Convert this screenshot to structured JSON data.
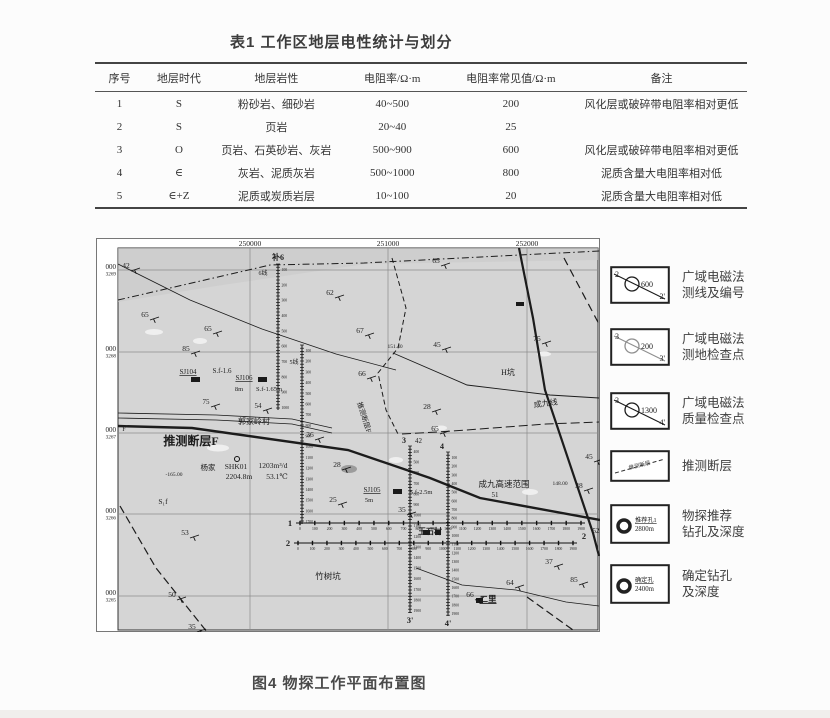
{
  "table": {
    "title": "表1 工作区地层电性统计与划分",
    "headers": [
      "序号",
      "地层时代",
      "地层岩性",
      "电阻率/Ω·m",
      "电阻率常见值/Ω·m",
      "备注"
    ],
    "col_widths": [
      48,
      70,
      122,
      108,
      136,
      168
    ],
    "rows": [
      [
        "1",
        "S",
        "粉砂岩、细砂岩",
        "40~500",
        "200",
        "风化层或破碎带电阻率相对更低"
      ],
      [
        "2",
        "S",
        "页岩",
        "20~40",
        "25",
        ""
      ],
      [
        "3",
        "O",
        "页岩、石英砂岩、灰岩",
        "500~900",
        "600",
        "风化层或破碎带电阻率相对更低"
      ],
      [
        "4",
        "∈",
        "灰岩、泥质灰岩",
        "500~1000",
        "800",
        "泥质含量大电阻率相对低"
      ],
      [
        "5",
        "∈+Z",
        "泥质或炭质岩层",
        "10~100",
        "20",
        "泥质含量大电阻率相对低"
      ]
    ]
  },
  "figure": {
    "caption": "图4 物探工作平面布置图",
    "map": {
      "bg": "#d5d5d5",
      "band": "#c9c9c9",
      "easting": [
        {
          "t": "250000",
          "x": 154
        },
        {
          "t": "251000",
          "x": 292
        },
        {
          "t": "252000",
          "x": 431
        }
      ],
      "northing": [
        {
          "a": "000",
          "b": "3269",
          "y": 32
        },
        {
          "a": "000",
          "b": "3268",
          "y": 114
        },
        {
          "a": "000",
          "b": "3267",
          "y": 195
        },
        {
          "a": "000",
          "b": "3266",
          "y": 276
        },
        {
          "a": "000",
          "b": "3265",
          "y": 358
        }
      ],
      "grid": {
        "vx": [
          154,
          292,
          431
        ],
        "hy": [
          32,
          114,
          195,
          276,
          358
        ]
      },
      "paths": [
        {
          "pts": [
            [
              22,
              62
            ],
            [
              174,
              27
            ],
            [
              268,
              25
            ],
            [
              423,
              17
            ],
            [
              504,
              13
            ]
          ],
          "w": 1,
          "dash": "7,3,1.5,3"
        },
        {
          "pts": [
            [
              22,
              26
            ],
            [
              94,
              62
            ],
            [
              166,
              91
            ],
            [
              240,
              116
            ],
            [
              300,
              132
            ]
          ],
          "w": 0.8
        },
        {
          "pts": [
            [
              297,
              115
            ],
            [
              371,
              147
            ],
            [
              454,
              157
            ],
            [
              503,
              160
            ]
          ],
          "w": 0.9
        },
        {
          "pts": [
            [
              423,
              10
            ],
            [
              437,
              80
            ],
            [
              449,
              152
            ],
            [
              497,
              295
            ],
            [
              503,
              318
            ]
          ],
          "w": 2.2
        },
        {
          "pts": [
            [
              468,
              20
            ],
            [
              504,
              88
            ]
          ],
          "w": 1.2,
          "dash": "8,5"
        },
        {
          "pts": [
            [
              22,
              188
            ],
            [
              96,
              190
            ],
            [
              252,
              212
            ],
            [
              334,
              240
            ],
            [
              384,
              260
            ],
            [
              504,
              282
            ]
          ],
          "w": 2.4
        },
        {
          "pts": [
            [
              22,
              175
            ],
            [
              120,
              177
            ],
            [
              196,
              181
            ],
            [
              236,
              190
            ]
          ],
          "w": 0.8
        },
        {
          "pts": [
            [
              22,
              180
            ],
            [
              120,
              182
            ],
            [
              196,
              186
            ],
            [
              236,
              195
            ]
          ],
          "w": 0.8
        },
        {
          "pts": [
            [
              296,
              20
            ],
            [
              310,
              70
            ],
            [
              302,
              110
            ],
            [
              282,
              135
            ],
            [
              290,
              172
            ],
            [
              302,
              196
            ]
          ],
          "w": 1,
          "dash": "5,3"
        },
        {
          "pts": [
            [
              306,
              196
            ],
            [
              357,
              193
            ],
            [
              450,
              186
            ],
            [
              503,
              184
            ]
          ],
          "w": 1,
          "dash": "9,4"
        },
        {
          "pts": [
            [
              24,
              268
            ],
            [
              60,
              330
            ],
            [
              111,
              394
            ]
          ],
          "w": 1.2,
          "dash": "8,4"
        },
        {
          "pts": [
            [
              431,
              359
            ],
            [
              477,
              392
            ]
          ],
          "w": 1.2,
          "dash": "8,4"
        },
        {
          "pts": [
            [
              320,
              330
            ],
            [
              366,
              347
            ],
            [
              420,
              352
            ],
            [
              470,
              364
            ],
            [
              503,
              368
            ]
          ],
          "w": 0.8
        }
      ],
      "v_lines": [
        {
          "x": 182,
          "y1": 26,
          "y2": 172,
          "stations": [
            "100",
            "200",
            "300",
            "400",
            "500",
            "600",
            "700",
            "800",
            "900",
            "1000"
          ]
        },
        {
          "x": 206,
          "y1": 107,
          "y2": 286,
          "stations": [
            "100",
            "200",
            "300",
            "400",
            "500",
            "600",
            "700",
            "800",
            "900",
            "1000",
            "1100",
            "1200",
            "1300",
            "1400",
            "1500",
            "1600",
            "1700"
          ]
        },
        {
          "x": 314,
          "y1": 208,
          "y2": 375,
          "top": "3",
          "top2": "42",
          "bottom": "3'",
          "stations": [
            "400",
            "500",
            "600",
            "700",
            "800",
            "900",
            "1000",
            "1100",
            "1200",
            "1300",
            "1400",
            "1500",
            "1600",
            "1700",
            "1800",
            "1900"
          ]
        },
        {
          "x": 352,
          "y1": 214,
          "y2": 378,
          "top": "4",
          "bottom": "4'",
          "stations": [
            "100",
            "200",
            "300",
            "400",
            "500",
            "600",
            "700",
            "800",
            "900",
            "1000",
            "1100",
            "1200",
            "1300",
            "1400",
            "1500",
            "1600",
            "1700",
            "1800",
            "1900"
          ]
        }
      ],
      "h_lines": [
        {
          "y": 285,
          "x1": 200,
          "x2": 489,
          "left": "1",
          "stations": [
            "0",
            "100",
            "200",
            "300",
            "400",
            "500",
            "600",
            "700",
            "800",
            "900",
            "1000",
            "1100",
            "1200",
            "1300",
            "1400",
            "1500",
            "1600",
            "1700",
            "1800",
            "1900"
          ]
        },
        {
          "y": 305,
          "x1": 198,
          "x2": 481,
          "left": "2",
          "right": "2",
          "stations": [
            "0",
            "100",
            "200",
            "300",
            "400",
            "500",
            "600",
            "700",
            "800",
            "900",
            "1000",
            "1100",
            "1200",
            "1300",
            "1400",
            "1500",
            "1600",
            "1700",
            "1800",
            "1900"
          ]
        }
      ],
      "labels": [
        {
          "t": "42",
          "x": 30,
          "y": 30,
          "s": 7.5,
          "dip": 1
        },
        {
          "t": "补6",
          "x": 182,
          "y": 22,
          "s": 8,
          "b": 1
        },
        {
          "t": "6线",
          "x": 167,
          "y": 37,
          "s": 6
        },
        {
          "t": "5线",
          "x": 198,
          "y": 126,
          "s": 6
        },
        {
          "t": "65",
          "x": 49,
          "y": 79,
          "s": 7.5,
          "dip": 1
        },
        {
          "t": "65",
          "x": 112,
          "y": 93,
          "s": 7.5,
          "dip": 1
        },
        {
          "t": "85",
          "x": 90,
          "y": 113,
          "s": 7.5,
          "dip": 1
        },
        {
          "t": "62",
          "x": 234,
          "y": 57,
          "s": 7.5,
          "dip": 1
        },
        {
          "t": "67",
          "x": 264,
          "y": 95,
          "s": 7.5,
          "dip": 1
        },
        {
          "t": "65",
          "x": 340,
          "y": 25,
          "s": 7.5,
          "dip": 1
        },
        {
          "t": "75",
          "x": 441,
          "y": 103,
          "s": 7.5,
          "dip": 1
        },
        {
          "t": "SJ104",
          "x": 92,
          "y": 136,
          "s": 7,
          "u": 1
        },
        {
          "t": "S.f-1.6",
          "x": 126,
          "y": 135,
          "s": 7
        },
        {
          "t": "SJ106",
          "x": 148,
          "y": 142,
          "s": 7,
          "u": 1
        },
        {
          "t": "8m",
          "x": 143,
          "y": 153,
          "s": 6.5
        },
        {
          "t": "S.f-1.65m",
          "x": 173,
          "y": 153,
          "s": 6.5
        },
        {
          "t": "75",
          "x": 110,
          "y": 166,
          "s": 7,
          "dip": 1
        },
        {
          "t": "54",
          "x": 162,
          "y": 170,
          "s": 7,
          "dip": 1
        },
        {
          "t": "郭家岭村",
          "x": 158,
          "y": 186,
          "s": 8
        },
        {
          "t": "推测断层F",
          "x": 95,
          "y": 207,
          "s": 12,
          "b": 1
        },
        {
          "t": "F",
          "x": 28,
          "y": 193,
          "s": 6.5
        },
        {
          "t": "杨家",
          "x": 112,
          "y": 232,
          "s": 7.5
        },
        {
          "t": "SHK01",
          "x": 140,
          "y": 231,
          "s": 7.5
        },
        {
          "t": "1203m³/d",
          "x": 177,
          "y": 230,
          "s": 7.5
        },
        {
          "t": "2204.8m",
          "x": 143,
          "y": 241,
          "s": 7.5
        },
        {
          "t": "53.1℃",
          "x": 181,
          "y": 241,
          "s": 7.5
        },
        {
          "t": "-165.00",
          "x": 78,
          "y": 238,
          "s": 5.5
        },
        {
          "t": "S₁f",
          "x": 67,
          "y": 266,
          "s": 7.5
        },
        {
          "t": "53",
          "x": 89,
          "y": 297,
          "s": 7.5,
          "dip": 1
        },
        {
          "t": "50",
          "x": 76,
          "y": 359,
          "s": 7.5,
          "dip": 1
        },
        {
          "t": "35",
          "x": 96,
          "y": 391,
          "s": 7.5,
          "dip": 1
        },
        {
          "t": "竹树坑",
          "x": 232,
          "y": 341,
          "s": 8.5
        },
        {
          "t": "25",
          "x": 237,
          "y": 264,
          "s": 7.5,
          "dip": 1
        },
        {
          "t": "36",
          "x": 214,
          "y": 199,
          "s": 7.5,
          "dip": 1
        },
        {
          "t": "28",
          "x": 241,
          "y": 229,
          "s": 7.5,
          "dip": 1
        },
        {
          "t": "151.40",
          "x": 299,
          "y": 110,
          "s": 5.5
        },
        {
          "t": "45",
          "x": 341,
          "y": 109,
          "s": 7.5,
          "dip": 1
        },
        {
          "t": "66",
          "x": 266,
          "y": 138,
          "s": 7.5,
          "dip": 1
        },
        {
          "t": "H坑",
          "x": 412,
          "y": 137,
          "s": 8
        },
        {
          "t": "成九线",
          "x": 450,
          "y": 168,
          "s": 8,
          "r": -8
        },
        {
          "t": "28",
          "x": 331,
          "y": 171,
          "s": 7.5,
          "dip": 1
        },
        {
          "t": "65",
          "x": 339,
          "y": 193,
          "s": 7.5,
          "dip": 1
        },
        {
          "t": "推测断层F",
          "x": 266,
          "y": 180,
          "s": 7,
          "r": 72
        },
        {
          "t": "SJ105",
          "x": 276,
          "y": 254,
          "s": 7,
          "u": 1
        },
        {
          "t": "5m",
          "x": 273,
          "y": 264,
          "s": 6.5
        },
        {
          "t": "S.f-2.5m",
          "x": 325,
          "y": 256,
          "s": 6.5
        },
        {
          "t": "35",
          "x": 306,
          "y": 274,
          "s": 7.5,
          "dip": 1
        },
        {
          "t": "成九高速范围",
          "x": 408,
          "y": 249,
          "s": 8.5
        },
        {
          "t": "51",
          "x": 399,
          "y": 259,
          "s": 7
        },
        {
          "t": "148.00",
          "x": 464,
          "y": 247,
          "s": 5.5
        },
        {
          "t": "38",
          "x": 483,
          "y": 250,
          "s": 7.5,
          "dip": 1
        },
        {
          "t": "45",
          "x": 493,
          "y": 221,
          "s": 7.5,
          "dip": 1
        },
        {
          "t": "玉石村",
          "x": 334,
          "y": 296,
          "s": 8,
          "b": 1
        },
        {
          "t": "52",
          "x": 500,
          "y": 295,
          "s": 7,
          "dip": 1
        },
        {
          "t": "37",
          "x": 453,
          "y": 326,
          "s": 7.5,
          "dip": 1
        },
        {
          "t": "85",
          "x": 478,
          "y": 344,
          "s": 7.5,
          "dip": 1
        },
        {
          "t": "64",
          "x": 414,
          "y": 347,
          "s": 7.5,
          "dip": 1
        },
        {
          "t": "66",
          "x": 374,
          "y": 359,
          "s": 7.5,
          "dip": 1
        },
        {
          "t": "二里",
          "x": 392,
          "y": 364,
          "s": 8.5,
          "u": 1,
          "b": 1
        }
      ],
      "rects": [
        {
          "x": 95,
          "y": 139,
          "w": 9,
          "h": 5
        },
        {
          "x": 162,
          "y": 139,
          "w": 9,
          "h": 5
        },
        {
          "x": 297,
          "y": 251,
          "w": 9,
          "h": 5
        },
        {
          "x": 327,
          "y": 292,
          "w": 7,
          "h": 5
        },
        {
          "x": 339,
          "y": 292,
          "w": 6,
          "h": 5
        },
        {
          "x": 420,
          "y": 64,
          "w": 8,
          "h": 4
        },
        {
          "x": 380,
          "y": 360,
          "w": 7,
          "h": 5
        }
      ],
      "patches": [
        {
          "cx": 58,
          "cy": 94,
          "rx": 9,
          "ry": 3
        },
        {
          "cx": 104,
          "cy": 103,
          "rx": 7,
          "ry": 3
        },
        {
          "cx": 122,
          "cy": 210,
          "rx": 11,
          "ry": 3.5
        },
        {
          "cx": 434,
          "cy": 254,
          "rx": 8,
          "ry": 3
        },
        {
          "cx": 300,
          "cy": 222,
          "rx": 7,
          "ry": 3
        },
        {
          "cx": 448,
          "cy": 116,
          "rx": 7,
          "ry": 2.5
        },
        {
          "cx": 345,
          "cy": 190,
          "rx": 6,
          "ry": 2.5
        }
      ],
      "pond": {
        "cx": 253,
        "cy": 231,
        "rx": 8,
        "ry": 4
      },
      "well": {
        "cx": 141,
        "cy": 221,
        "r": 2.5
      }
    },
    "legend": {
      "items": [
        {
          "type": "line",
          "tl": "2",
          "br": "2'",
          "value": "600",
          "faint": false,
          "label": [
            "广域电磁法",
            "测线及编号"
          ],
          "top": 28
        },
        {
          "type": "line",
          "tl": "3",
          "br": "3'",
          "value": "200",
          "faint": true,
          "label": [
            "广域电磁法",
            "测地检查点"
          ],
          "top": 90
        },
        {
          "type": "line",
          "tl": "3",
          "br": "4'",
          "value": "1300",
          "faint": false,
          "label": [
            "广域电磁法",
            "质量检查点"
          ],
          "top": 154
        },
        {
          "type": "dash",
          "text": "推测断层",
          "label": [
            "推测断层"
          ],
          "top": 212
        },
        {
          "type": "hole",
          "name": "推荐孔1",
          "depth": "2800m",
          "label": [
            "物探推荐",
            "钻孔及深度"
          ],
          "top": 266
        },
        {
          "type": "hole",
          "name": "确定孔",
          "depth": "2400m",
          "label": [
            "确定钻孔",
            "及深度"
          ],
          "top": 326
        }
      ]
    }
  }
}
